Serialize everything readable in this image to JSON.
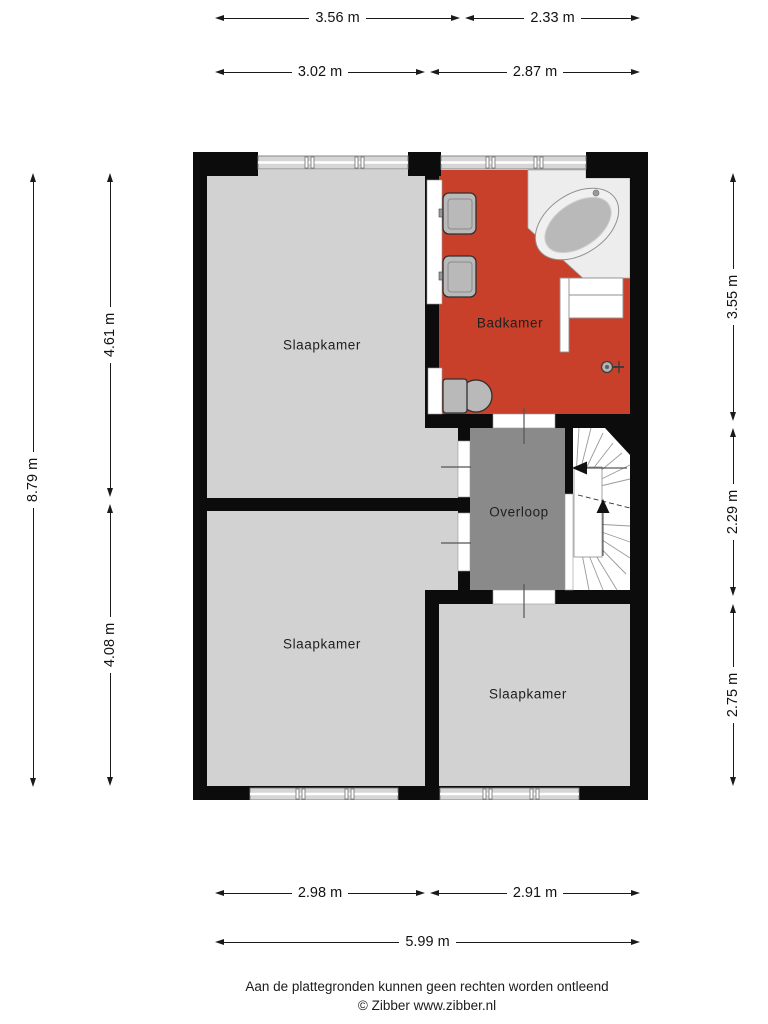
{
  "plan": {
    "type": "floor-plan",
    "floor_rooms": [
      {
        "id": "bedroom_top_left",
        "label": "Slaapkamer"
      },
      {
        "id": "bathroom",
        "label": "Badkamer"
      },
      {
        "id": "landing",
        "label": "Overloop"
      },
      {
        "id": "bedroom_bottom_left",
        "label": "Slaapkamer"
      },
      {
        "id": "bedroom_bottom_right",
        "label": "Slaapkamer"
      }
    ]
  },
  "rooms": {
    "bedroom_top_left": "Slaapkamer",
    "bathroom": "Badkamer",
    "landing": "Overloop",
    "bedroom_bottom_left": "Slaapkamer",
    "bedroom_bottom_right": "Slaapkamer"
  },
  "dimensions": {
    "top_outer_left": "3.56 m",
    "top_outer_right": "2.33 m",
    "top_inner_left": "3.02 m",
    "top_inner_right": "2.87 m",
    "left_outer": "8.79 m",
    "left_upper": "4.61 m",
    "left_lower": "4.08 m",
    "right_upper": "3.55 m",
    "right_middle": "2.29 m",
    "right_lower": "2.75 m",
    "bottom_left": "2.98 m",
    "bottom_right": "2.91 m",
    "bottom_outer": "5.99 m"
  },
  "footer": {
    "line1": "Aan de plattegronden kunnen geen rechten worden ontleend",
    "line2": "© Zibber www.zibber.nl"
  },
  "colors": {
    "wall": "#0c0c0c",
    "bedroom": "#d2d2d2",
    "bathroom": "#c8402a",
    "landing": "#8a8a8a",
    "fixture": "#b9b9b9",
    "platform": "#ededed"
  }
}
